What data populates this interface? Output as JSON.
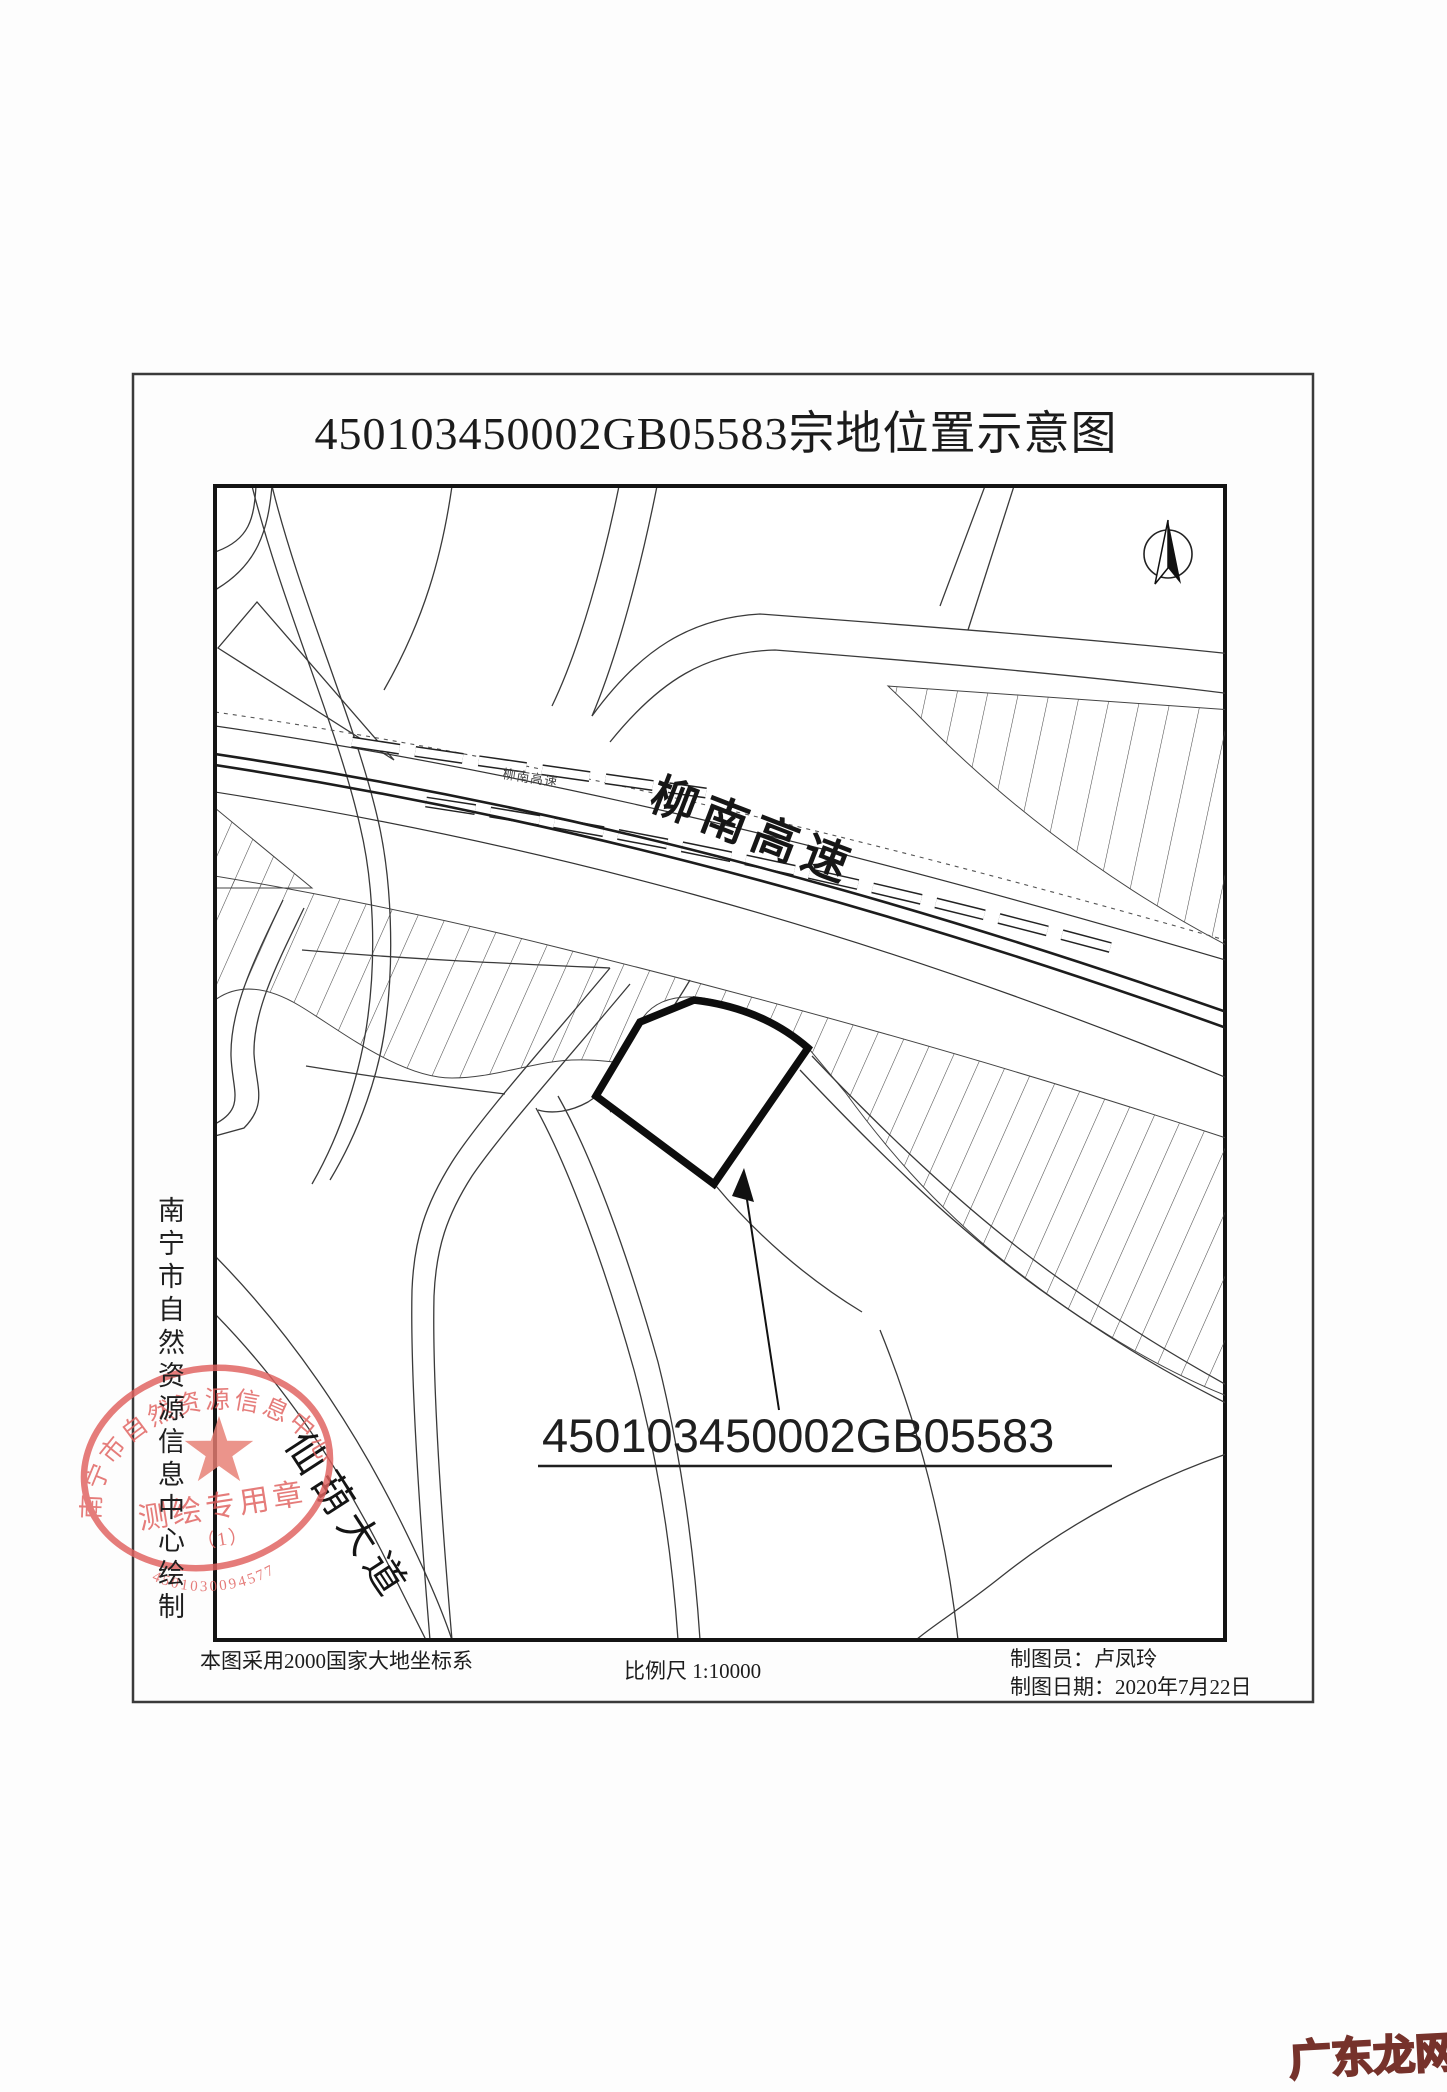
{
  "document": {
    "title": "450103450002GB05583宗地位置示意图",
    "watermark": "广东龙网"
  },
  "map": {
    "labels": {
      "expressway": "柳南高速",
      "expressway_small": "柳南高速",
      "avenue": "仙葫大道"
    },
    "parcel_id": "450103450002GB05583"
  },
  "seal": {
    "ring_text": "南宁市自然资源信息中心",
    "type_label": "测绘专用章",
    "index_label": "（1）",
    "serial": "4501030094577"
  },
  "attribution": "南宁市自然资源信息中心绘制",
  "footer": {
    "coordinate_note": "本图采用2000国家大地坐标系",
    "scale": "比例尺 1:10000",
    "drafter": "制图员：卢凤玲",
    "date": "制图日期：2020年7月22日"
  },
  "colors": {
    "ink": "#2b2b2b",
    "seal_red": "#e0605e",
    "watermark_stroke": "#76322b"
  }
}
